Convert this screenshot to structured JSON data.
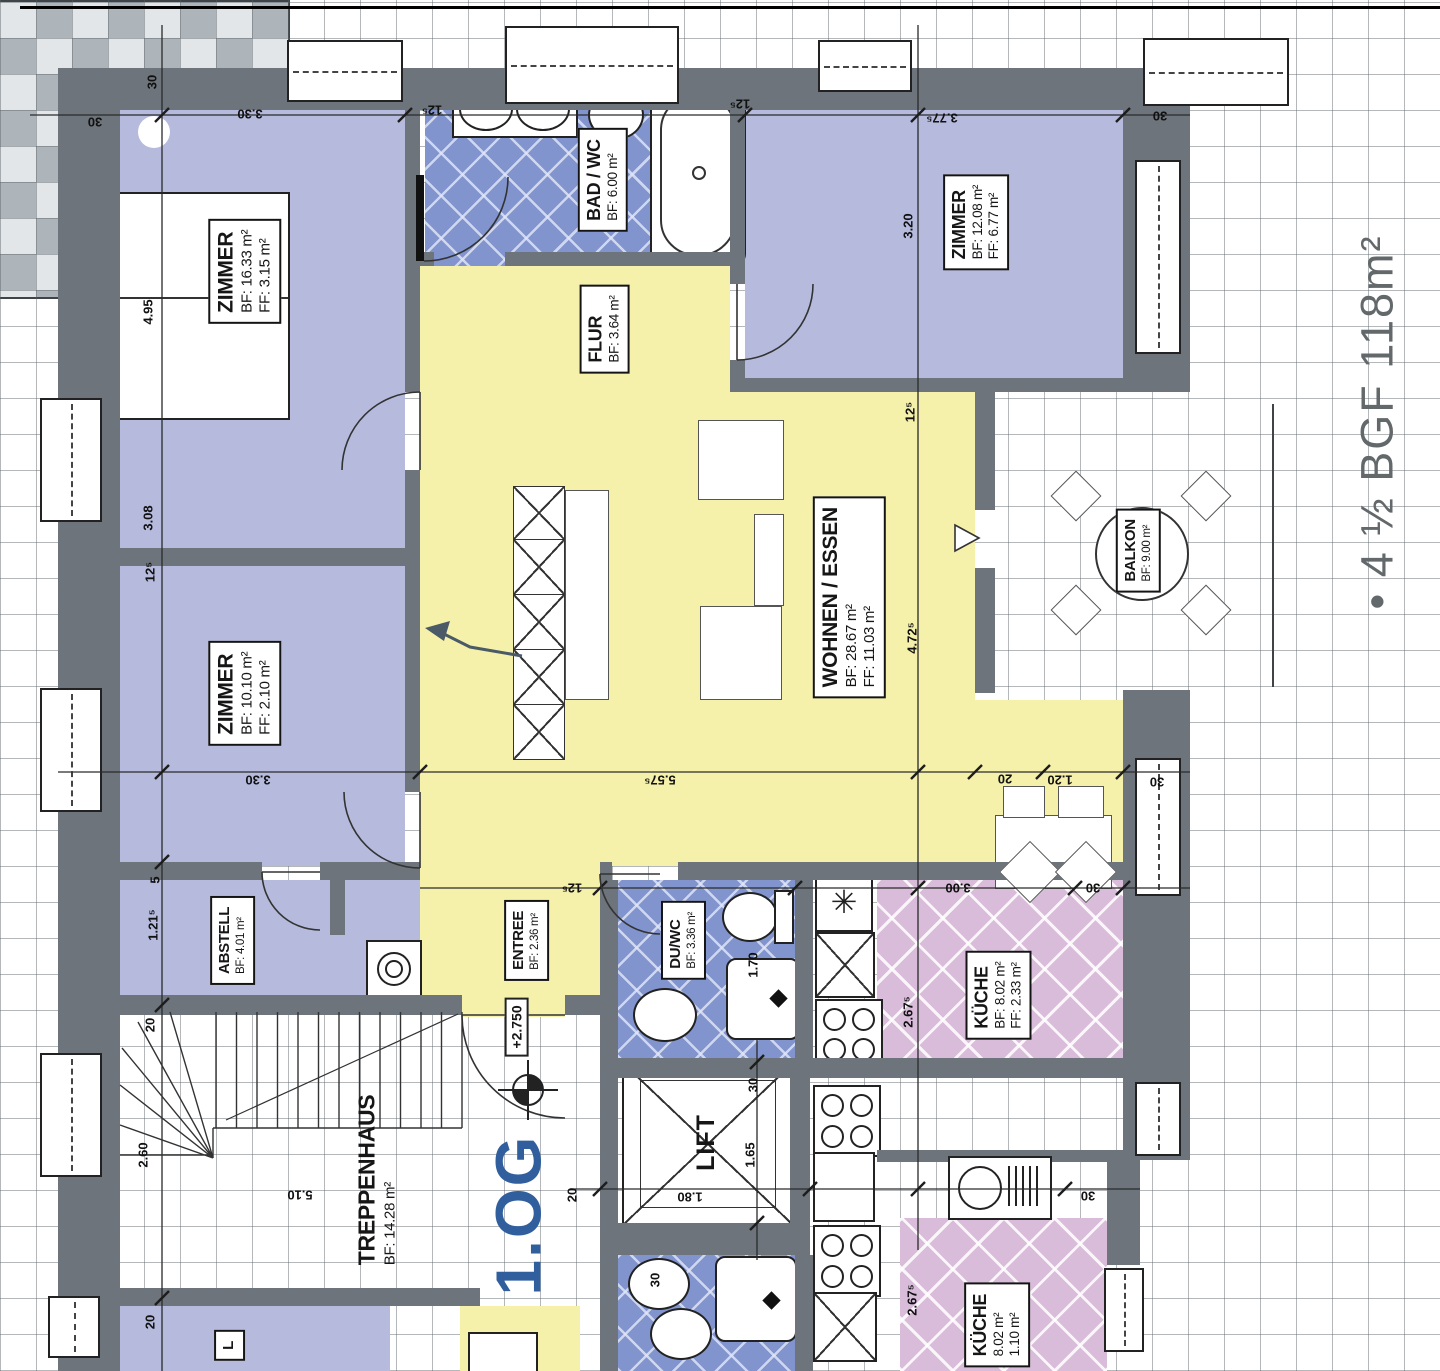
{
  "note": {
    "text": "• 4 ½  BGF  118m²"
  },
  "floor": {
    "level": "1.OG",
    "elevation": "+2.750"
  },
  "rooms": {
    "zimmer_nw": {
      "name": "ZIMMER",
      "bf": "BF: 16.33 m²",
      "ff": "FF: 3.15 m²"
    },
    "bad_wc": {
      "name": "BAD / WC",
      "bf": "BF: 6.00 m²"
    },
    "flur": {
      "name": "FLUR",
      "bf": "BF: 3.64 m²"
    },
    "zimmer_ne": {
      "name": "ZIMMER",
      "bf": "BF: 12.08 m²",
      "ff": "FF: 6.77 m²"
    },
    "wohnen_essen": {
      "name": "WOHNEN / ESSEN",
      "bf": "BF: 28.67 m²",
      "ff": "FF: 11.03 m²"
    },
    "balkon": {
      "name": "BALKON",
      "bf": "BF: 9.00 m²"
    },
    "zimmer_w": {
      "name": "ZIMMER",
      "bf": "BF: 10.10 m²",
      "ff": "FF: 2.10 m²"
    },
    "abstell": {
      "name": "ABSTELL",
      "bf": "BF: 4.01 m²"
    },
    "entree": {
      "name": "ENTREE",
      "bf": "BF: 2.36 m²"
    },
    "du_wc": {
      "name": "DU/WC",
      "bf": "BF: 3.36 m²"
    },
    "kueche": {
      "name": "KÜCHE",
      "bf": "BF: 8.02 m²",
      "ff": "FF: 2.33 m²"
    },
    "treppenhaus": {
      "name": "TREPPENHAUS",
      "bf": "BF: 14.28 m²"
    },
    "lift": {
      "name": "LIFT"
    },
    "kueche_eg": {
      "name": "KÜCHE",
      "bf": "8.02 m²",
      "ff": "1.10 m²"
    },
    "room_partial": {
      "name": "L"
    }
  },
  "dims": [
    {
      "t": "30",
      "x": 95,
      "y": 122,
      "r": 180
    },
    {
      "t": "30",
      "x": 152,
      "y": 82,
      "r": -90
    },
    {
      "t": "3.30",
      "x": 250,
      "y": 114,
      "r": 180
    },
    {
      "t": "12⁵",
      "x": 432,
      "y": 110,
      "r": 180
    },
    {
      "t": "12⁵",
      "x": 740,
      "y": 104,
      "r": 180
    },
    {
      "t": "3.77⁵",
      "x": 942,
      "y": 118,
      "r": 180
    },
    {
      "t": "30",
      "x": 1160,
      "y": 116,
      "r": 180
    },
    {
      "t": "4.95",
      "x": 148,
      "y": 312,
      "r": -90
    },
    {
      "t": "3.20",
      "x": 908,
      "y": 226,
      "r": -90
    },
    {
      "t": "12⁵",
      "x": 910,
      "y": 412,
      "r": -90
    },
    {
      "t": "4.72⁵",
      "x": 912,
      "y": 638,
      "r": -90
    },
    {
      "t": "3.08",
      "x": 148,
      "y": 518,
      "r": -90
    },
    {
      "t": "12⁵",
      "x": 150,
      "y": 572,
      "r": -90
    },
    {
      "t": "3.30",
      "x": 258,
      "y": 780,
      "r": 180
    },
    {
      "t": "5.57⁵",
      "x": 660,
      "y": 780,
      "r": 180
    },
    {
      "t": "20",
      "x": 1005,
      "y": 779,
      "r": 180
    },
    {
      "t": "1.20",
      "x": 1060,
      "y": 780,
      "r": 180
    },
    {
      "t": "30",
      "x": 1157,
      "y": 782,
      "r": 180
    },
    {
      "t": "5",
      "x": 155,
      "y": 880,
      "r": -90
    },
    {
      "t": "1.21⁵",
      "x": 153,
      "y": 925,
      "r": -90
    },
    {
      "t": "12⁵",
      "x": 572,
      "y": 888,
      "r": 180
    },
    {
      "t": "3.00",
      "x": 958,
      "y": 888,
      "r": 180
    },
    {
      "t": "30",
      "x": 1093,
      "y": 888,
      "r": 180
    },
    {
      "t": "1.70",
      "x": 753,
      "y": 965,
      "r": -90
    },
    {
      "t": "2.67⁵",
      "x": 908,
      "y": 1012,
      "r": -90
    },
    {
      "t": "20",
      "x": 150,
      "y": 1025,
      "r": -90
    },
    {
      "t": "2.60",
      "x": 143,
      "y": 1155,
      "r": -90
    },
    {
      "t": "5.10",
      "x": 300,
      "y": 1195,
      "r": 180
    },
    {
      "t": "30",
      "x": 753,
      "y": 1085,
      "r": -90
    },
    {
      "t": "1.65",
      "x": 750,
      "y": 1155,
      "r": -90
    },
    {
      "t": "1.80",
      "x": 690,
      "y": 1197,
      "r": 180
    },
    {
      "t": "20",
      "x": 572,
      "y": 1195,
      "r": -90
    },
    {
      "t": "30",
      "x": 655,
      "y": 1280,
      "r": -90
    },
    {
      "t": "2.67⁵",
      "x": 912,
      "y": 1300,
      "r": -90
    },
    {
      "t": "30",
      "x": 1088,
      "y": 1196,
      "r": 180
    },
    {
      "t": "20",
      "x": 150,
      "y": 1322,
      "r": -90
    }
  ],
  "colors": {
    "wall": "#6d747b",
    "room": "#b6bbde",
    "hall": "#f5f0aa",
    "bath": "#8294cd",
    "kitchen": "#d9bcd9",
    "level_blue": "#315f9e",
    "note_gray": "#63686b"
  }
}
